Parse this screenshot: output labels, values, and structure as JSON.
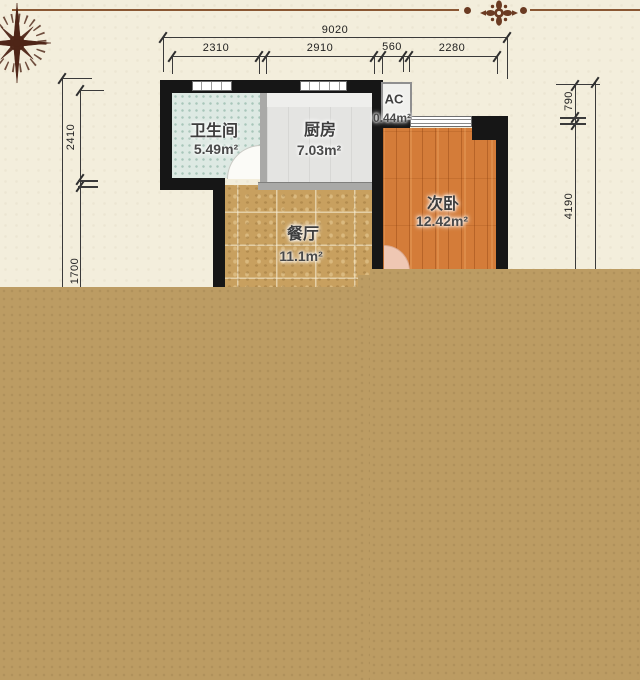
{
  "meta": {
    "type": "floorplan-screenshot",
    "language": "zh-CN"
  },
  "decor": {
    "compass_icon": "compass-rose",
    "ornament_icon": "floral-medallion",
    "line_color": "#8a5733",
    "ornament_color": "#6b3b22"
  },
  "rooms": {
    "bathroom": {
      "name": "卫生间",
      "area": "5.49m²"
    },
    "kitchen": {
      "name": "厨房",
      "area": "7.03m²"
    },
    "ac": {
      "name": "AC",
      "area": "0.44m²"
    },
    "bedroom": {
      "name": "次卧",
      "area": "12.42m²"
    },
    "dining": {
      "name": "餐厅",
      "area": "11.1m²"
    }
  },
  "dimensions": {
    "top_total": "9020",
    "top_segments": [
      "2310",
      "2910",
      "560",
      "2280"
    ],
    "left_segments": [
      "2410",
      "1700"
    ],
    "right_segments": [
      "790",
      "4190"
    ]
  },
  "colors": {
    "background": "#f3eedc",
    "cover_block": "#bc9c63",
    "wall": "#161616",
    "bathroom_floor": "#dde9e3",
    "kitchen_floor": "#e4e4e2",
    "dining_floor": "#c8a05f",
    "bedroom_floor": "#d47c39"
  }
}
